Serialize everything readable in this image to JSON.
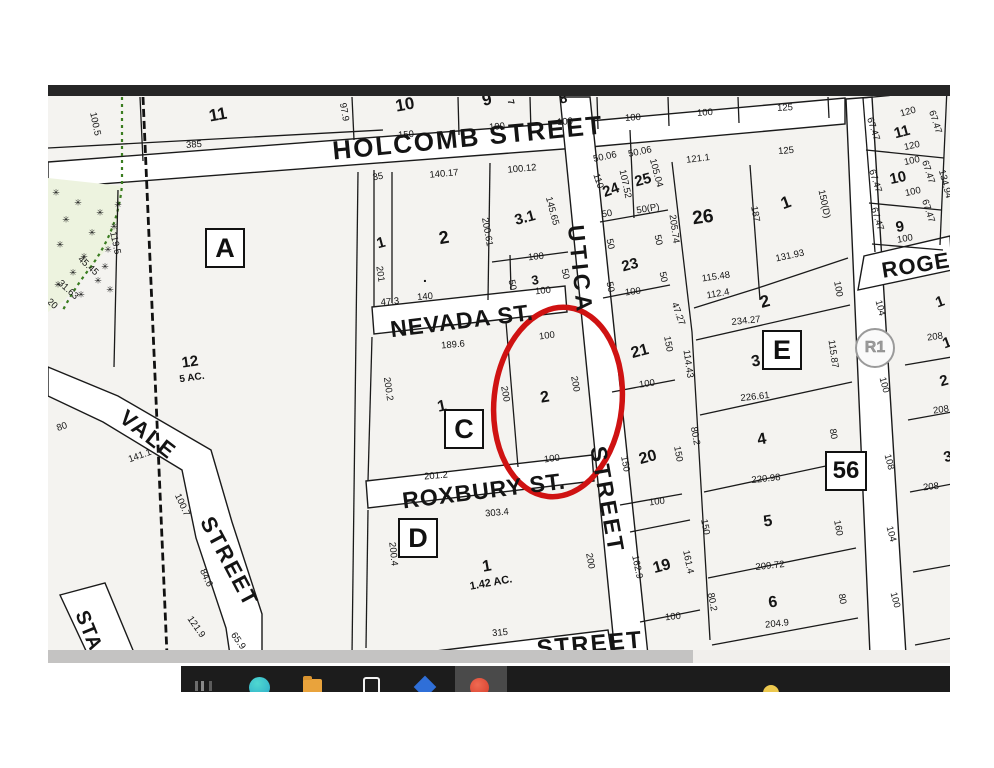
{
  "map": {
    "street_labels": [
      {
        "t": "HOLCOMB STREET",
        "x": 420,
        "y": 53,
        "r": -5.5,
        "fs": 26,
        "ls": 2
      },
      {
        "t": "NEVADA ST.",
        "x": 414,
        "y": 236,
        "r": -7,
        "fs": 23,
        "ls": 1
      },
      {
        "t": "ROXBURY ST.",
        "x": 436,
        "y": 406,
        "r": -7,
        "fs": 23,
        "ls": 1
      },
      {
        "t": "UTICA",
        "x": 532,
        "y": 185,
        "r": 84,
        "fs": 23,
        "ls": 4
      },
      {
        "t": "STREET",
        "x": 559,
        "y": 415,
        "r": 80,
        "fs": 23,
        "ls": 3
      },
      {
        "t": "VALE",
        "x": 100,
        "y": 350,
        "r": 38,
        "fs": 22,
        "ls": 2
      },
      {
        "t": "STREET",
        "x": 181,
        "y": 477,
        "r": 62,
        "fs": 22,
        "ls": 2
      },
      {
        "t": "ROGERS",
        "x": 884,
        "y": 178,
        "r": -9,
        "fs": 22,
        "ls": 1
      },
      {
        "t": "STREET",
        "x": 542,
        "y": 560,
        "r": -5,
        "fs": 24,
        "ls": 2
      },
      {
        "t": "STA",
        "x": 40,
        "y": 546,
        "r": 68,
        "fs": 20,
        "ls": 1
      }
    ],
    "block_labels": [
      {
        "t": "A",
        "x": 177,
        "y": 163
      },
      {
        "t": "C",
        "x": 416,
        "y": 344
      },
      {
        "t": "D",
        "x": 370,
        "y": 453
      },
      {
        "t": "E",
        "x": 734,
        "y": 265
      }
    ],
    "lot_badge": {
      "t": "56",
      "x": 798,
      "y": 386
    },
    "zone_badge": {
      "t": "R1",
      "x": 827,
      "y": 263
    },
    "parcel_numbers": [
      [
        "11",
        170,
        30,
        -10,
        17
      ],
      [
        "10",
        357,
        20,
        -10,
        17
      ],
      [
        "9",
        439,
        15,
        -12,
        17
      ],
      [
        "8",
        515,
        13,
        -15,
        14
      ],
      [
        "7",
        463,
        17,
        75,
        9
      ],
      [
        "11",
        854,
        47,
        -15,
        15
      ],
      [
        "10",
        850,
        93,
        -12,
        15
      ],
      [
        "9",
        852,
        142,
        -10,
        15
      ],
      [
        "1",
        333,
        158,
        -15,
        15
      ],
      [
        "2",
        396,
        153,
        -10,
        18
      ],
      [
        "3.1",
        477,
        133,
        -15,
        15
      ],
      [
        "3",
        487,
        195,
        -10,
        13
      ],
      [
        ".",
        377,
        192,
        0,
        14
      ],
      [
        "24",
        563,
        105,
        -20,
        15
      ],
      [
        "25",
        595,
        95,
        -15,
        15
      ],
      [
        "26",
        655,
        133,
        -8,
        19
      ],
      [
        "1",
        738,
        118,
        -20,
        17
      ],
      [
        "2",
        717,
        217,
        -15,
        17
      ],
      [
        "23",
        582,
        180,
        -15,
        15
      ],
      [
        "21",
        592,
        267,
        -15,
        16
      ],
      [
        "20",
        600,
        373,
        -15,
        16
      ],
      [
        "19",
        614,
        482,
        -15,
        16
      ],
      [
        "3",
        708,
        277,
        -10,
        16
      ],
      [
        "4",
        714,
        355,
        -10,
        16
      ],
      [
        "5",
        720,
        437,
        -8,
        16
      ],
      [
        "6",
        725,
        518,
        -8,
        16
      ],
      [
        "1",
        394,
        322,
        -12,
        16
      ],
      [
        "2",
        497,
        313,
        -10,
        16
      ],
      [
        "1",
        439,
        482,
        -10,
        16
      ],
      [
        "12",
        142,
        277,
        -8,
        15
      ],
      [
        "5 AC.",
        144,
        293,
        -8,
        10
      ],
      [
        "1.42 AC.",
        443,
        498,
        -10,
        11
      ],
      [
        "1",
        892,
        217,
        -20,
        15
      ],
      [
        "1",
        899,
        258,
        -20,
        15
      ],
      [
        "2",
        896,
        296,
        -15,
        15
      ],
      [
        "3",
        900,
        372,
        -15,
        15
      ]
    ],
    "dimensions": [
      [
        "100.5",
        47,
        39,
        78
      ],
      [
        "385",
        146,
        60,
        -4
      ],
      [
        "97.9",
        296,
        27,
        80
      ],
      [
        "150",
        358,
        50,
        -5
      ],
      [
        "100",
        449,
        42,
        -5
      ],
      [
        "100",
        517,
        37,
        -5
      ],
      [
        "100",
        585,
        33,
        -4
      ],
      [
        "100",
        657,
        28,
        -4
      ],
      [
        "125",
        737,
        23,
        -3
      ],
      [
        "119.5",
        67,
        158,
        78
      ],
      [
        "45.45",
        40,
        181,
        42
      ],
      [
        "31.63",
        20,
        205,
        42
      ],
      [
        "20",
        4,
        219,
        42
      ],
      [
        "35",
        330,
        92,
        -10
      ],
      [
        "140.17",
        396,
        89,
        -5
      ],
      [
        "100.12",
        474,
        84,
        -5
      ],
      [
        "201",
        332,
        189,
        82
      ],
      [
        "200.61",
        439,
        147,
        80
      ],
      [
        "145.65",
        504,
        126,
        75
      ],
      [
        "100",
        488,
        172,
        -6
      ],
      [
        "50",
        464,
        200,
        78
      ],
      [
        "50",
        517,
        189,
        78
      ],
      [
        "100",
        495,
        206,
        -6
      ],
      [
        "47.3",
        342,
        217,
        -5
      ],
      [
        "140",
        377,
        212,
        -5
      ],
      [
        "50.06",
        557,
        72,
        -12
      ],
      [
        "50.06",
        592,
        67,
        -12
      ],
      [
        "110",
        550,
        96,
        72
      ],
      [
        "107.52",
        577,
        99,
        78
      ],
      [
        "105.04",
        608,
        88,
        75
      ],
      [
        "50",
        559,
        129,
        -10
      ],
      [
        "50(P)",
        600,
        124,
        -10
      ],
      [
        "121.1",
        650,
        74,
        -7
      ],
      [
        "205.74",
        626,
        144,
        82
      ],
      [
        "187",
        707,
        129,
        80
      ],
      [
        "125",
        738,
        66,
        -5
      ],
      [
        "150(D)",
        776,
        119,
        78
      ],
      [
        "131.93",
        742,
        171,
        -12
      ],
      [
        "115.48",
        668,
        192,
        -8
      ],
      [
        "112.4",
        670,
        209,
        -10
      ],
      [
        "100",
        790,
        204,
        80
      ],
      [
        "234.27",
        698,
        236,
        -6
      ],
      [
        "47.27",
        630,
        229,
        70
      ],
      [
        "50",
        562,
        159,
        78
      ],
      [
        "50",
        610,
        155,
        78
      ],
      [
        "100",
        585,
        207,
        -7
      ],
      [
        "50",
        562,
        202,
        78
      ],
      [
        "50",
        615,
        192,
        78
      ],
      [
        "150",
        620,
        259,
        80
      ],
      [
        "114.43",
        640,
        279,
        82
      ],
      [
        "115.87",
        785,
        269,
        82
      ],
      [
        "100",
        599,
        299,
        -8
      ],
      [
        "226.61",
        707,
        312,
        -6
      ],
      [
        "80.2",
        647,
        351,
        80
      ],
      [
        "80",
        785,
        349,
        80
      ],
      [
        "150",
        577,
        379,
        80
      ],
      [
        "150",
        630,
        369,
        80
      ],
      [
        "220.98",
        718,
        394,
        -6
      ],
      [
        "100",
        609,
        417,
        -7
      ],
      [
        "150",
        657,
        442,
        80
      ],
      [
        "160",
        790,
        443,
        80
      ],
      [
        "209.72",
        722,
        481,
        -6
      ],
      [
        "162.9",
        589,
        482,
        78
      ],
      [
        "161.4",
        640,
        477,
        78
      ],
      [
        "80.2",
        664,
        517,
        80
      ],
      [
        "80",
        794,
        514,
        80
      ],
      [
        "204.9",
        729,
        539,
        -6
      ],
      [
        "100",
        625,
        532,
        -6
      ],
      [
        "189.6",
        405,
        260,
        -5
      ],
      [
        "200.2",
        340,
        304,
        82
      ],
      [
        "201.2",
        388,
        391,
        -5
      ],
      [
        "200",
        457,
        309,
        80
      ],
      [
        "100",
        499,
        251,
        -7
      ],
      [
        "200",
        527,
        299,
        80
      ],
      [
        "100",
        504,
        374,
        -7
      ],
      [
        "303.4",
        449,
        428,
        -5
      ],
      [
        "200.4",
        345,
        469,
        84
      ],
      [
        "200",
        542,
        476,
        80
      ],
      [
        "315",
        452,
        548,
        -5
      ],
      [
        "80",
        14,
        342,
        -20
      ],
      [
        "141.1",
        92,
        371,
        -20
      ],
      [
        "100.7",
        134,
        420,
        65
      ],
      [
        "84.6",
        158,
        493,
        65
      ],
      [
        "121.9",
        148,
        542,
        55
      ],
      [
        "65.9",
        190,
        556,
        55
      ],
      [
        "120",
        860,
        27,
        -15
      ],
      [
        "67.47",
        825,
        44,
        72
      ],
      [
        "67.47",
        887,
        37,
        72
      ],
      [
        "120",
        864,
        61,
        -12
      ],
      [
        "100",
        864,
        76,
        -12
      ],
      [
        "67.47",
        827,
        96,
        72
      ],
      [
        "67.47",
        880,
        87,
        72
      ],
      [
        "134.94",
        897,
        99,
        75
      ],
      [
        "100",
        865,
        107,
        -12
      ],
      [
        "67.47",
        829,
        134,
        72
      ],
      [
        "67.47",
        880,
        126,
        72
      ],
      [
        "100",
        857,
        154,
        -10
      ],
      [
        "104",
        832,
        223,
        75
      ],
      [
        "208",
        887,
        252,
        -8
      ],
      [
        "100",
        836,
        300,
        75
      ],
      [
        "208",
        893,
        325,
        -8
      ],
      [
        "108",
        841,
        377,
        75
      ],
      [
        "208",
        883,
        402,
        -6
      ],
      [
        "104",
        843,
        449,
        75
      ],
      [
        "100",
        847,
        515,
        75
      ]
    ],
    "veg_symbol": "✳",
    "veg_marks": [
      [
        8,
        108
      ],
      [
        30,
        118
      ],
      [
        52,
        128
      ],
      [
        18,
        135
      ],
      [
        44,
        148
      ],
      [
        66,
        142
      ],
      [
        12,
        160
      ],
      [
        36,
        172
      ],
      [
        60,
        165
      ],
      [
        25,
        188
      ],
      [
        50,
        196
      ],
      [
        10,
        200
      ],
      [
        33,
        210
      ],
      [
        57,
        182
      ],
      [
        70,
        120
      ],
      [
        62,
        205
      ]
    ],
    "colors": {
      "highlight_red": "#cf1212",
      "vegetation_green": "#3a7d20",
      "map_background": "#f4f3f0",
      "street_white": "#ffffff"
    }
  },
  "taskbar": {
    "icons": [
      {
        "name": "partial-app-icon",
        "cls": "ic-partial"
      },
      {
        "name": "teal-app-icon",
        "cls": "ic-teal"
      },
      {
        "name": "folder-icon",
        "cls": "ic-folder"
      },
      {
        "name": "window-outline-icon",
        "cls": "ic-square"
      },
      {
        "name": "blue-diamond-app-icon",
        "cls": "ic-diamond"
      },
      {
        "name": "red-app-icon",
        "cls": "ic-red"
      },
      {
        "name": "yellow-dot-icon",
        "cls": "ic-yellow"
      }
    ]
  }
}
